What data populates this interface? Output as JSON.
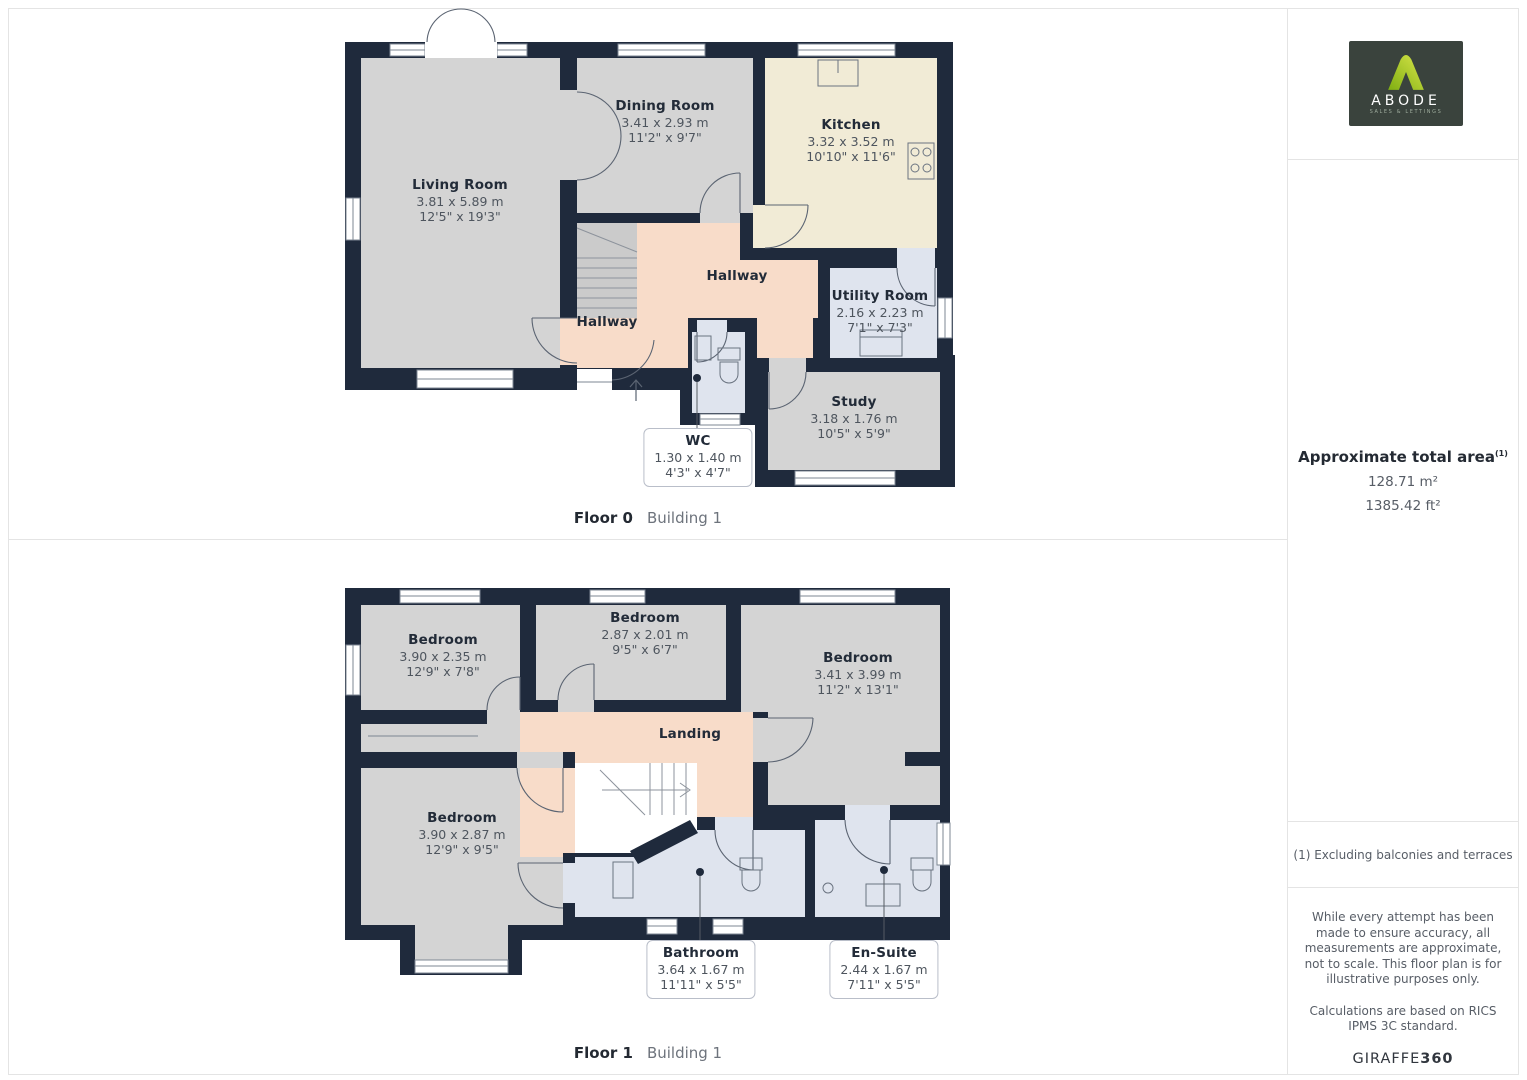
{
  "floors": [
    {
      "caption": {
        "floor": "Floor 0",
        "building": "Building 1"
      },
      "rooms": {
        "living": {
          "name": "Living Room",
          "metric": "3.81 x 5.89 m",
          "imperial": "12'5\" x 19'3\""
        },
        "dining": {
          "name": "Dining Room",
          "metric": "3.41 x 2.93 m",
          "imperial": "11'2\" x 9'7\""
        },
        "kitchen": {
          "name": "Kitchen",
          "metric": "3.32 x 3.52 m",
          "imperial": "10'10\" x 11'6\""
        },
        "hallway_upper": {
          "name": "Hallway"
        },
        "hallway_lower": {
          "name": "Hallway"
        },
        "utility": {
          "name": "Utility Room",
          "metric": "2.16 x 2.23 m",
          "imperial": "7'1\" x 7'3\""
        },
        "study": {
          "name": "Study",
          "metric": "3.18 x 1.76 m",
          "imperial": "10'5\" x 5'9\""
        },
        "wc": {
          "name": "WC",
          "metric": "1.30 x 1.40 m",
          "imperial": "4'3\" x 4'7\""
        }
      }
    },
    {
      "caption": {
        "floor": "Floor 1",
        "building": "Building 1"
      },
      "rooms": {
        "bedroom_tl": {
          "name": "Bedroom",
          "metric": "3.90 x 2.35 m",
          "imperial": "12'9\" x 7'8\""
        },
        "bedroom_tm": {
          "name": "Bedroom",
          "metric": "2.87 x 2.01 m",
          "imperial": "9'5\" x 6'7\""
        },
        "bedroom_r": {
          "name": "Bedroom",
          "metric": "3.41 x 3.99 m",
          "imperial": "11'2\" x 13'1\""
        },
        "landing": {
          "name": "Landing"
        },
        "bedroom_bl": {
          "name": "Bedroom",
          "metric": "3.90 x 2.87 m",
          "imperial": "12'9\" x 9'5\""
        },
        "bathroom": {
          "name": "Bathroom",
          "metric": "3.64 x 1.67 m",
          "imperial": "11'11\" x 5'5\""
        },
        "ensuite": {
          "name": "En-Suite",
          "metric": "2.44 x 1.67 m",
          "imperial": "7'11\" x 5'5\""
        }
      }
    }
  ],
  "sidebar": {
    "logo": {
      "brand": "ABODE",
      "tagline": "SALES & LETTINGS"
    },
    "area": {
      "title": "Approximate total area",
      "footnote_marker": "(1)",
      "metric": "128.71 m²",
      "imperial": "1385.42 ft²"
    },
    "footnote": "(1) Excluding balconies and terraces",
    "disclaimer": "While every attempt has been made to ensure accuracy, all measurements are approximate, not to scale. This floor plan is for illustrative purposes only.",
    "standard": "Calculations are based on RICS IPMS 3C standard.",
    "brand_footer": {
      "name": "GIRAFFE",
      "suffix": "360"
    }
  },
  "colors": {
    "wall": "#1f2a3c",
    "room_gray": "#d4d4d4",
    "kitchen_cream": "#f1ebd6",
    "hallway_peach": "#f8dcc9",
    "wet_room_blue": "#dfe4ee",
    "logo_green": "#a8c830",
    "logo_background": "#3a433d"
  }
}
